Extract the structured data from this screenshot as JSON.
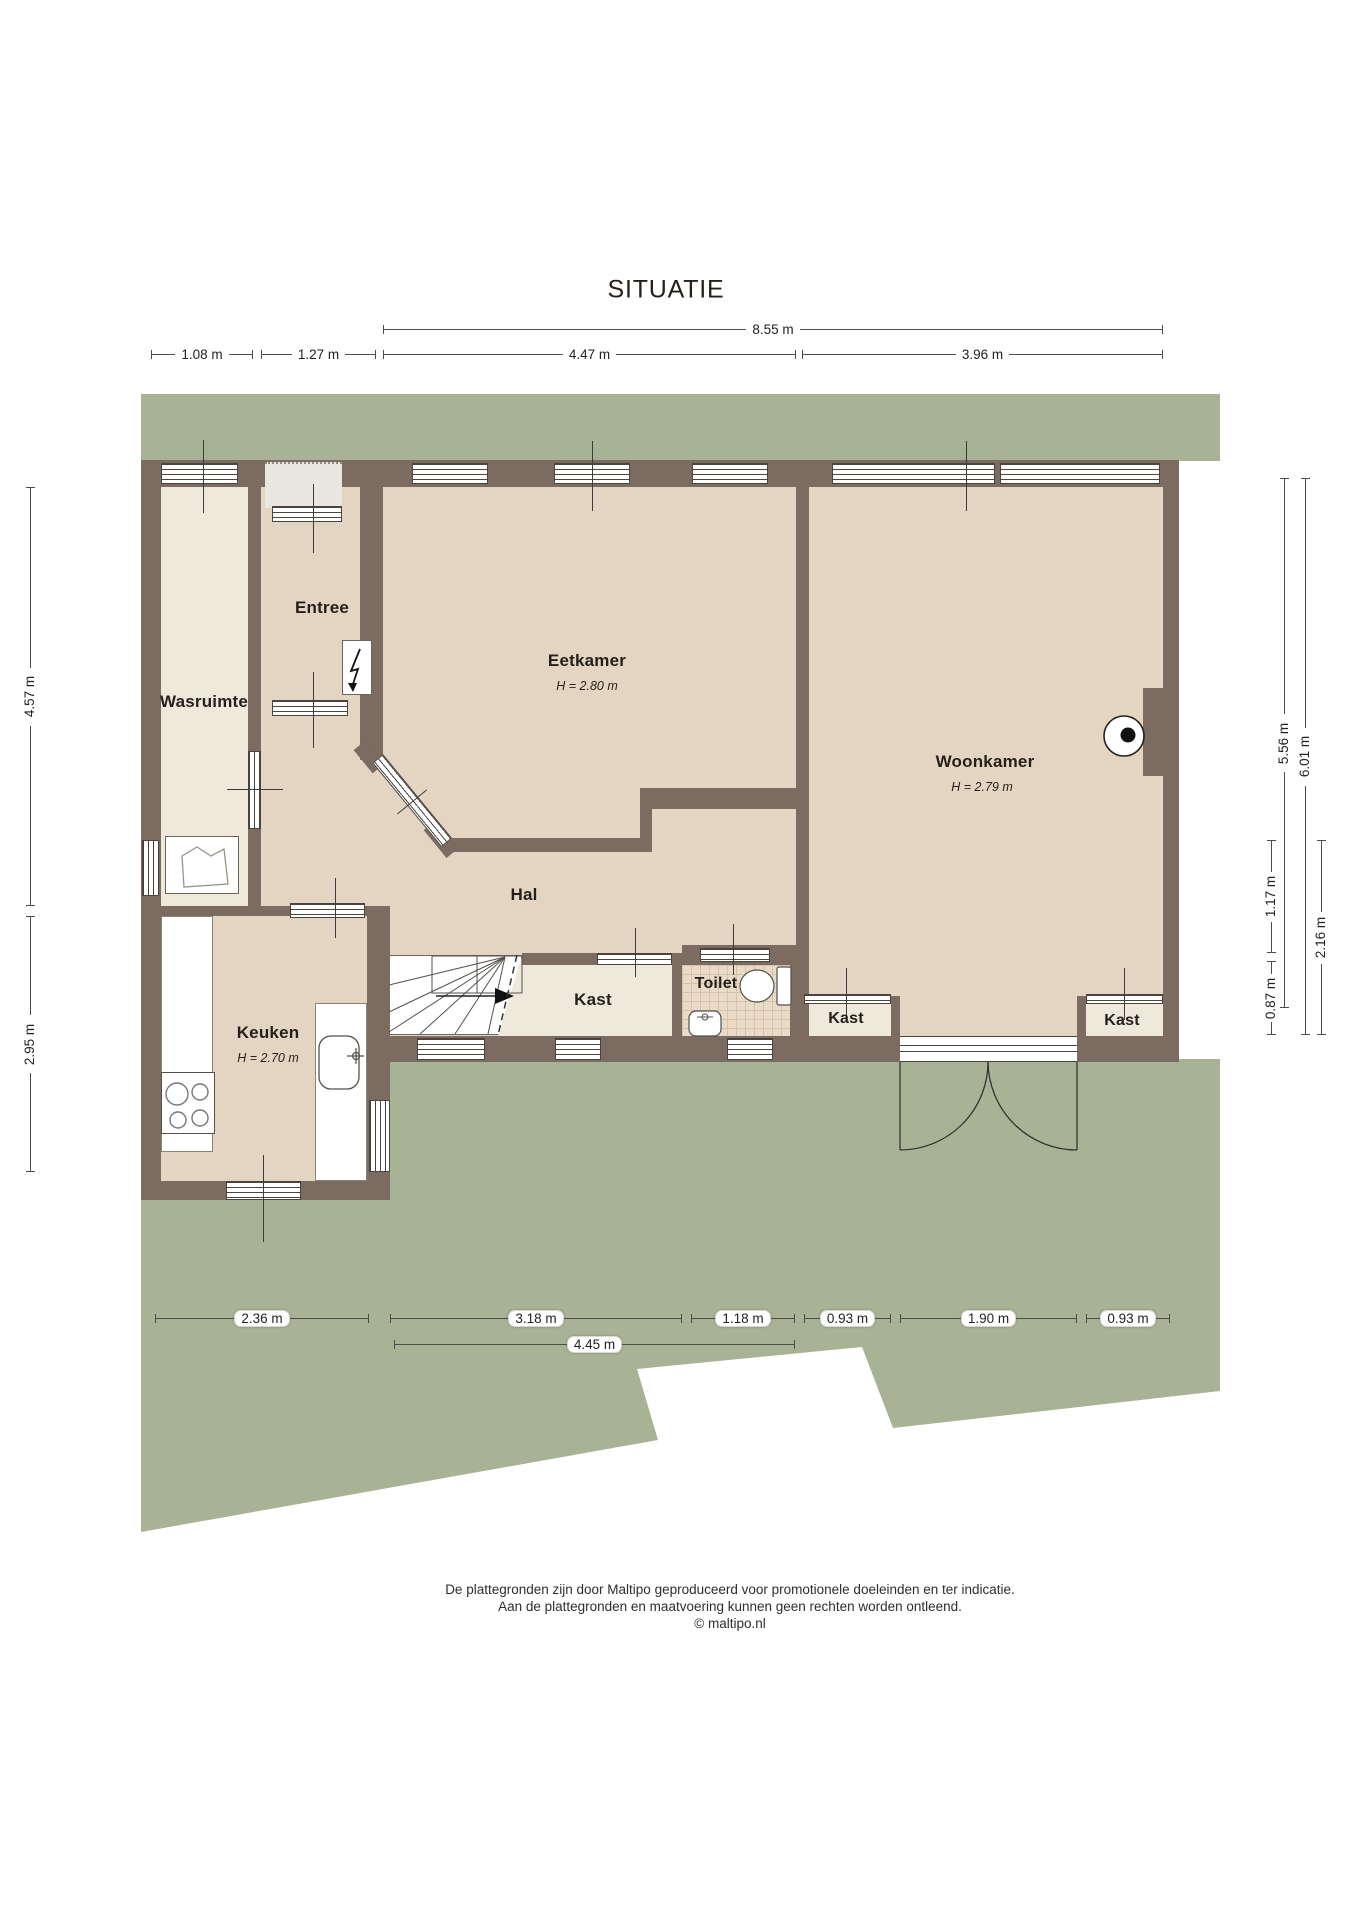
{
  "title": "SITUATIE",
  "colors": {
    "garden": "#a7b394",
    "wall": "#7b6b60",
    "room": "#e4d5c2",
    "roomAlt": "#efe9dc",
    "porch": "#e9e7df",
    "tile": "#e9dbc7",
    "tileLine": "#d6c2a8",
    "text": "#241f1a"
  },
  "rooms": {
    "wasruimte": {
      "label": "Wasruimte"
    },
    "entree": {
      "label": "Entree"
    },
    "eetkamer": {
      "label": "Eetkamer",
      "height": "H = 2.80 m"
    },
    "woonkamer": {
      "label": "Woonkamer",
      "height": "H = 2.79 m"
    },
    "hal": {
      "label": "Hal"
    },
    "keuken": {
      "label": "Keuken",
      "height": "H = 2.70 m"
    },
    "kast_hal": {
      "label": "Kast"
    },
    "toilet": {
      "label": "Toilet"
    },
    "kast_links": {
      "label": "Kast"
    },
    "kast_rechts": {
      "label": "Kast"
    }
  },
  "dimensions": {
    "top": [
      {
        "label": "8.55 m"
      }
    ],
    "top_sub": [
      {
        "label": "1.08 m"
      },
      {
        "label": "1.27 m"
      },
      {
        "label": "4.47 m"
      },
      {
        "label": "3.96 m"
      }
    ],
    "left": [
      {
        "label": "4.57 m"
      },
      {
        "label": "2.95 m"
      }
    ],
    "right": [
      {
        "label": "5.56 m"
      },
      {
        "label": "6.01 m"
      },
      {
        "label": "1.17 m"
      },
      {
        "label": "0.87 m"
      },
      {
        "label": "2.16 m"
      }
    ],
    "bottom": [
      {
        "label": "2.36 m"
      },
      {
        "label": "3.18 m"
      },
      {
        "label": "1.18 m"
      },
      {
        "label": "0.93 m"
      },
      {
        "label": "1.90 m"
      },
      {
        "label": "0.93 m"
      }
    ],
    "bottom_sub": [
      {
        "label": "4.45 m"
      }
    ]
  },
  "symbols": {
    "meter": "lightning-bolt",
    "boiler": "wall-flue-connection",
    "stairs": "winder-stairs-arrow-up",
    "washer": "laundry",
    "double_door": "garden-double-door-swing"
  },
  "footer": {
    "line1": "De plattegronden zijn door Maltipo geproduceerd voor promotionele doeleinden en ter indicatie.",
    "line2": "Aan de plattegronden en maatvoering kunnen geen rechten worden ontleend.",
    "line3": "© maltipo.nl"
  }
}
